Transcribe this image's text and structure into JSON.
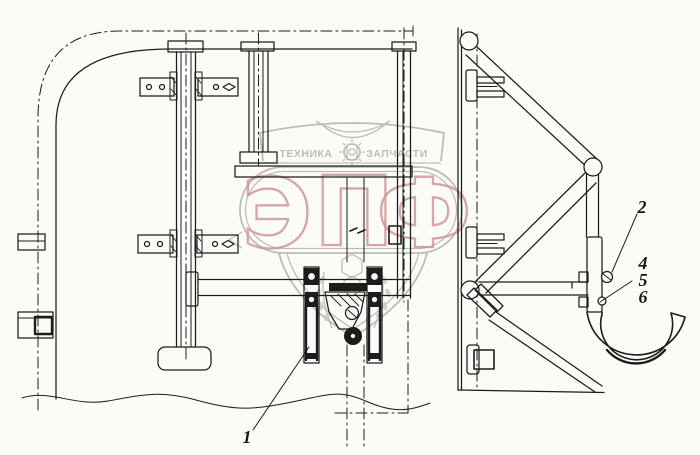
{
  "drawing": {
    "line_color": "#1c1c1c",
    "background": "#fbfbf8"
  },
  "watermark": {
    "letters": [
      "Э",
      "П",
      "Ф"
    ],
    "top_left_text": "ТЕХНИКА",
    "top_right_text": "ЗАПЧАСТИ",
    "outline_color": "#b5b2ae",
    "letter_color": "#c98585"
  },
  "callouts": [
    {
      "label": "1"
    },
    {
      "label": "2"
    },
    {
      "label": "4"
    },
    {
      "label": "5"
    },
    {
      "label": "6"
    }
  ]
}
